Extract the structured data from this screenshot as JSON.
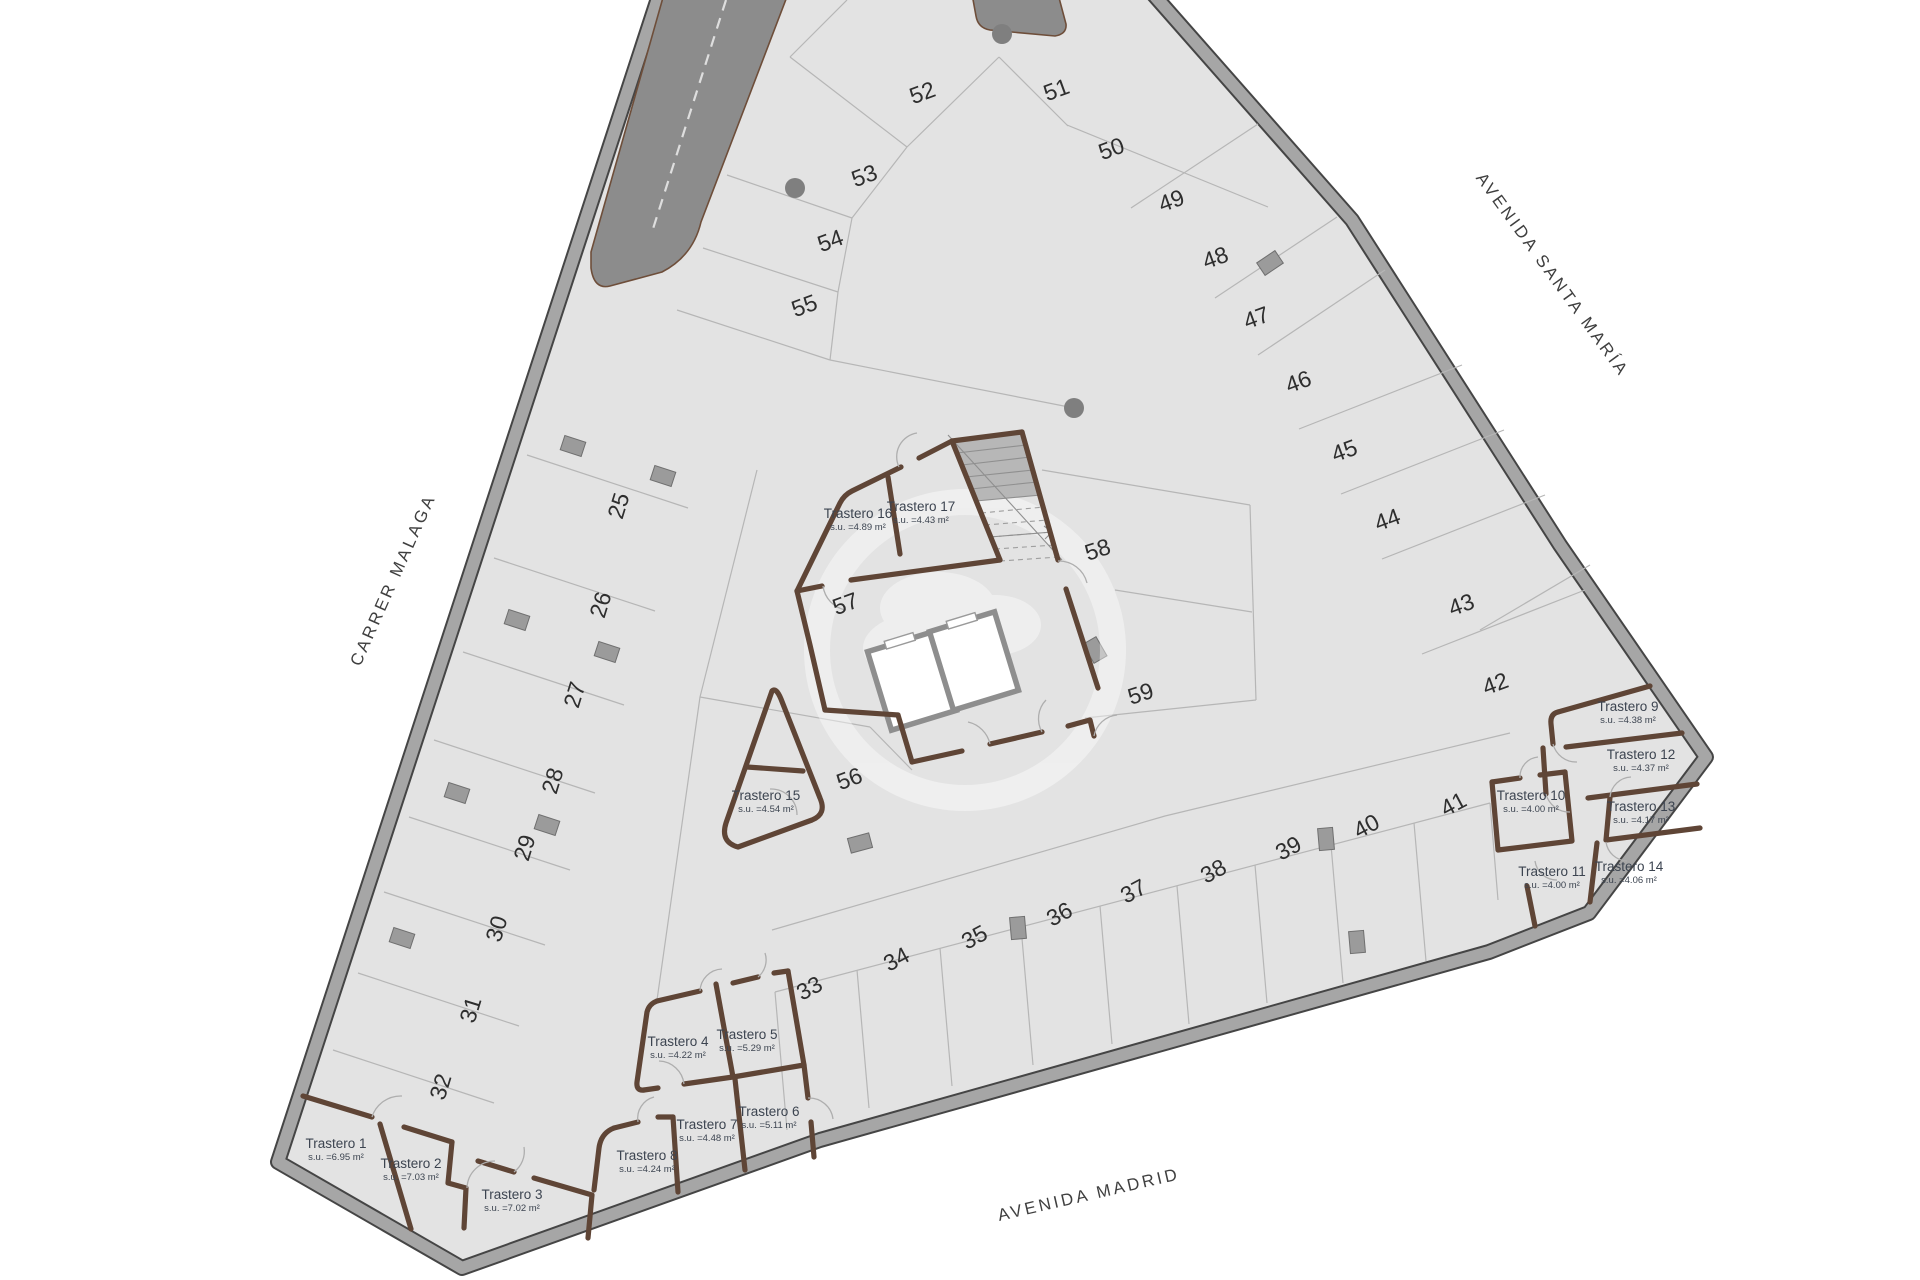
{
  "plan": {
    "type": "basement parking floor plan",
    "streets": [
      {
        "id": "carrer-malaga",
        "label": "CARRER MALAGA",
        "x": 398,
        "y": 582,
        "rotation": -66
      },
      {
        "id": "avenida-santa-maria",
        "label": "AVENIDA SANTA MARÍA",
        "x": 1548,
        "y": 278,
        "rotation": 54
      },
      {
        "id": "avenida-madrid",
        "label": "AVENIDA MADRID",
        "x": 1090,
        "y": 1200,
        "rotation": -13
      }
    ],
    "parking_spots": [
      {
        "label": "25",
        "x": 626,
        "y": 508,
        "rotation": -73
      },
      {
        "label": "26",
        "x": 608,
        "y": 607,
        "rotation": -73
      },
      {
        "label": "27",
        "x": 582,
        "y": 697,
        "rotation": -73
      },
      {
        "label": "28",
        "x": 560,
        "y": 783,
        "rotation": -73
      },
      {
        "label": "29",
        "x": 532,
        "y": 850,
        "rotation": -73
      },
      {
        "label": "30",
        "x": 504,
        "y": 931,
        "rotation": -73
      },
      {
        "label": "31",
        "x": 478,
        "y": 1012,
        "rotation": -73
      },
      {
        "label": "32",
        "x": 448,
        "y": 1089,
        "rotation": -73
      },
      {
        "label": "33",
        "x": 813,
        "y": 995,
        "rotation": -28
      },
      {
        "label": "34",
        "x": 900,
        "y": 966,
        "rotation": -28
      },
      {
        "label": "35",
        "x": 978,
        "y": 944,
        "rotation": -28
      },
      {
        "label": "36",
        "x": 1063,
        "y": 921,
        "rotation": -28
      },
      {
        "label": "37",
        "x": 1137,
        "y": 898,
        "rotation": -28
      },
      {
        "label": "38",
        "x": 1217,
        "y": 878,
        "rotation": -28
      },
      {
        "label": "39",
        "x": 1292,
        "y": 855,
        "rotation": -28
      },
      {
        "label": "40",
        "x": 1370,
        "y": 833,
        "rotation": -28
      },
      {
        "label": "41",
        "x": 1457,
        "y": 811,
        "rotation": -28
      },
      {
        "label": "42",
        "x": 1498,
        "y": 691,
        "rotation": -20
      },
      {
        "label": "43",
        "x": 1464,
        "y": 612,
        "rotation": -20
      },
      {
        "label": "44",
        "x": 1390,
        "y": 527,
        "rotation": -20
      },
      {
        "label": "45",
        "x": 1347,
        "y": 458,
        "rotation": -20
      },
      {
        "label": "46",
        "x": 1301,
        "y": 389,
        "rotation": -20
      },
      {
        "label": "47",
        "x": 1259,
        "y": 325,
        "rotation": -20
      },
      {
        "label": "48",
        "x": 1218,
        "y": 265,
        "rotation": -20
      },
      {
        "label": "49",
        "x": 1174,
        "y": 208,
        "rotation": -20
      },
      {
        "label": "50",
        "x": 1114,
        "y": 156,
        "rotation": -20
      },
      {
        "label": "51",
        "x": 1059,
        "y": 97,
        "rotation": -20
      },
      {
        "label": "52",
        "x": 925,
        "y": 100,
        "rotation": -20
      },
      {
        "label": "53",
        "x": 867,
        "y": 183,
        "rotation": -20
      },
      {
        "label": "54",
        "x": 833,
        "y": 248,
        "rotation": -20
      },
      {
        "label": "55",
        "x": 807,
        "y": 313,
        "rotation": -20
      },
      {
        "label": "56",
        "x": 852,
        "y": 786,
        "rotation": -20
      },
      {
        "label": "57",
        "x": 848,
        "y": 611,
        "rotation": -20
      },
      {
        "label": "58",
        "x": 1100,
        "y": 557,
        "rotation": -18
      },
      {
        "label": "59",
        "x": 1143,
        "y": 701,
        "rotation": -18
      }
    ],
    "storage_rooms": [
      {
        "name": "Trastero 1",
        "area": "s.u. =6.95 m²",
        "x": 336,
        "y": 1148
      },
      {
        "name": "Trastero 2",
        "area": "s.u. =7.03 m²",
        "x": 411,
        "y": 1168
      },
      {
        "name": "Trastero 3",
        "area": "s.u. =7.02 m²",
        "x": 512,
        "y": 1199
      },
      {
        "name": "Trastero 4",
        "area": "s.u. =4.22 m²",
        "x": 678,
        "y": 1046
      },
      {
        "name": "Trastero 5",
        "area": "s.u. =5.29 m²",
        "x": 747,
        "y": 1039
      },
      {
        "name": "Trastero 6",
        "area": "s.u. =5.11 m²",
        "x": 769,
        "y": 1116
      },
      {
        "name": "Trastero 7",
        "area": "s.u. =4.48 m²",
        "x": 707,
        "y": 1129
      },
      {
        "name": "Trastero 8",
        "area": "s.u. =4.24 m²",
        "x": 647,
        "y": 1160
      },
      {
        "name": "Trastero 9",
        "area": "s.u. =4.38 m²",
        "x": 1628,
        "y": 711
      },
      {
        "name": "Trastero 10",
        "area": "s.u. =4.00 m²",
        "x": 1531,
        "y": 800
      },
      {
        "name": "Trastero 11",
        "area": "s.u. =4.00 m²",
        "x": 1552,
        "y": 876
      },
      {
        "name": "Trastero 12",
        "area": "s.u. =4.37 m²",
        "x": 1641,
        "y": 759
      },
      {
        "name": "Trastero 13",
        "area": "s.u. =4.17 m²",
        "x": 1641,
        "y": 811
      },
      {
        "name": "Trastero 14",
        "area": "s.u. =4.06 m²",
        "x": 1629,
        "y": 871
      },
      {
        "name": "Trastero 15",
        "area": "s.u. =4.54 m²",
        "x": 766,
        "y": 800
      },
      {
        "name": "Trastero 16",
        "area": "s.u. =4.89 m²",
        "x": 858,
        "y": 518
      },
      {
        "name": "Trastero 17",
        "area": "s.u. =4.43 m²",
        "x": 921,
        "y": 511
      }
    ]
  },
  "colors": {
    "floor": "#e3e3e3",
    "outer_wall": "#a6a6a6",
    "ramp": "#8c8c8c",
    "storage_wall": "#5f4536",
    "background": "#ffffff"
  }
}
